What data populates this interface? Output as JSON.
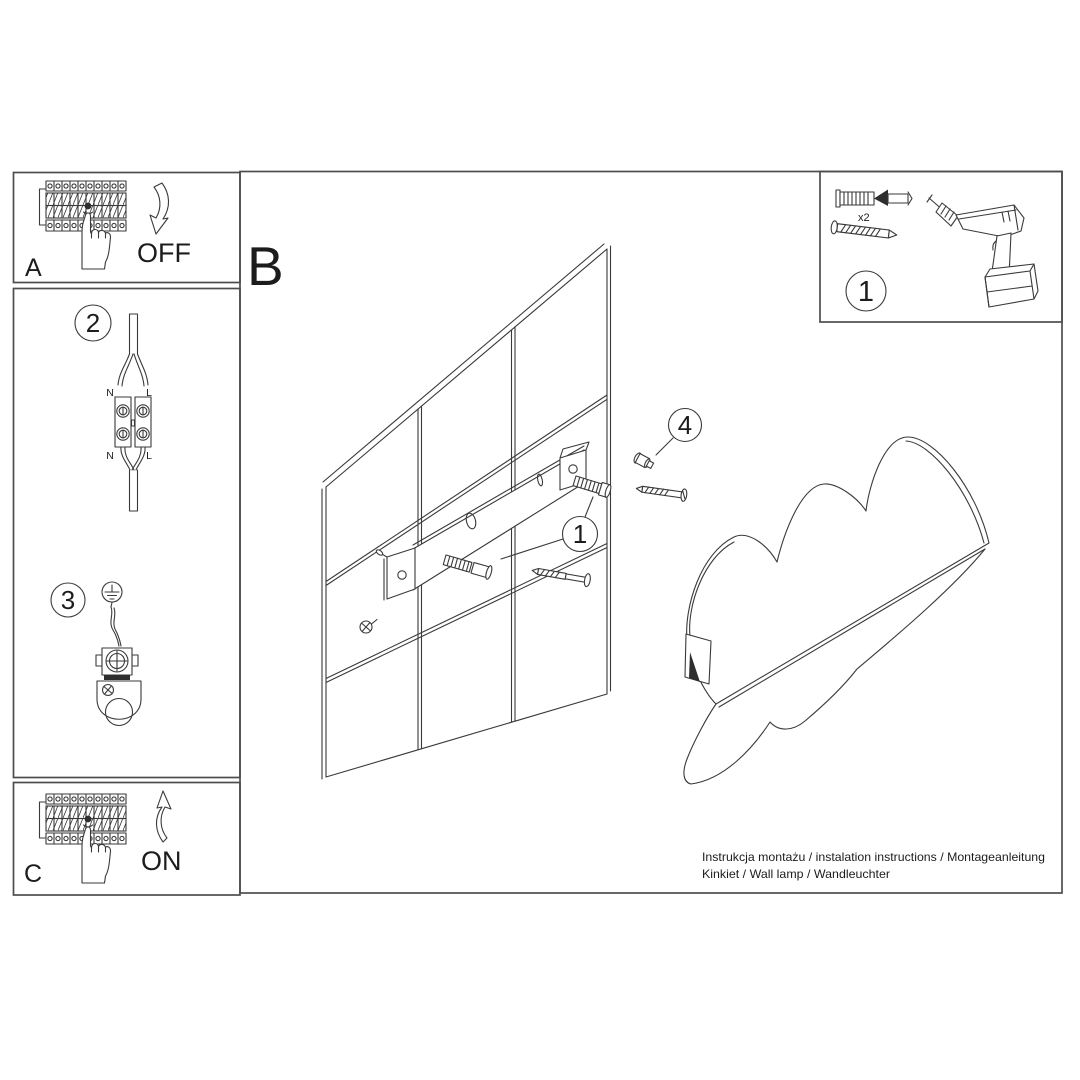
{
  "colors": {
    "line": "#3a3a3a",
    "border": "#4d4d4d",
    "text": "#1c1c1c",
    "dark_fill": "#2e2e2e",
    "background": "#ffffff"
  },
  "sections": {
    "a": {
      "label": "A",
      "switch_state": "OFF"
    },
    "b": {
      "label": "B"
    },
    "c": {
      "label": "C",
      "switch_state": "ON"
    }
  },
  "steps": {
    "wire_connection": {
      "number": "2",
      "terminals": {
        "top_n": "N",
        "top_l": "L",
        "bottom_n": "N",
        "bottom_l": "L"
      }
    },
    "ground_connection": {
      "number": "3"
    }
  },
  "callouts": {
    "anchor_set": "1",
    "cover_screw": "4"
  },
  "parts_box": {
    "number": "1",
    "plug_quantity": "x2"
  },
  "footer": {
    "line1": "Instrukcja montażu / instalation instructions / Montageanleitung",
    "line2": "Kinkiet / Wall lamp / Wandleuchter"
  }
}
